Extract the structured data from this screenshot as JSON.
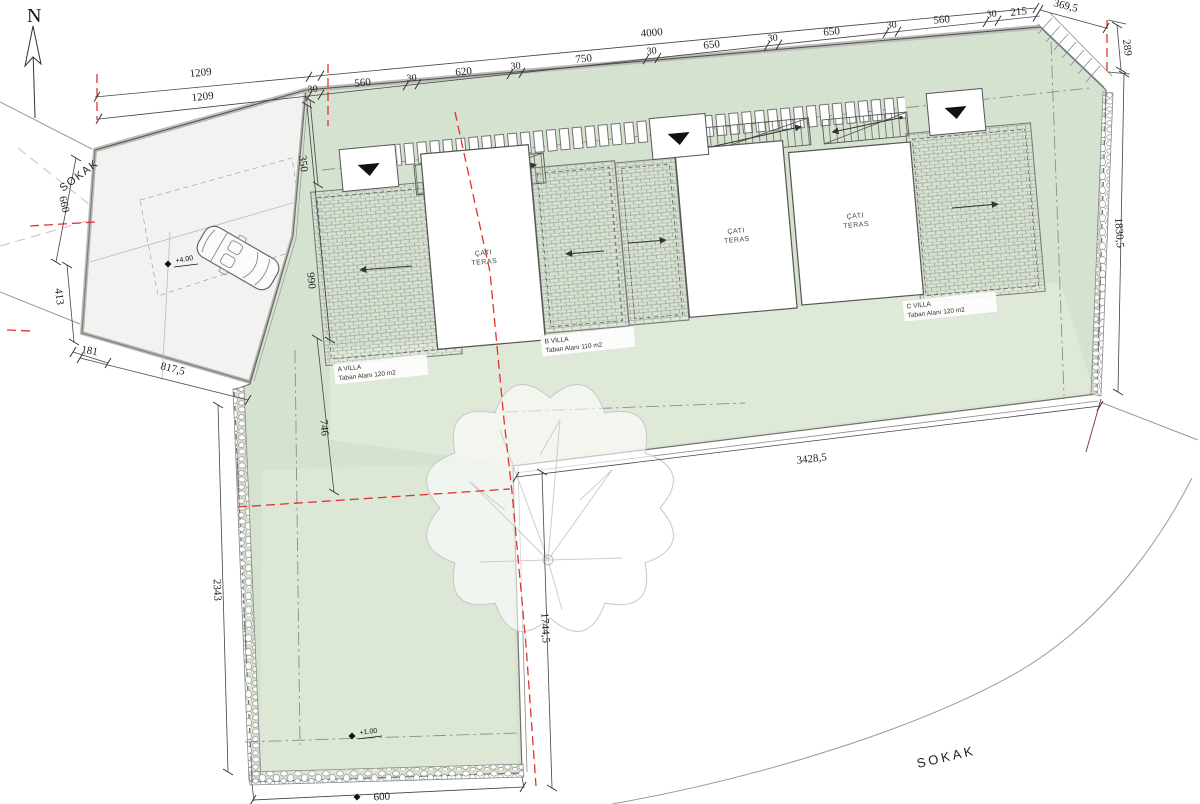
{
  "canvas": {
    "green": "#d6e2d0",
    "green_light": "#e4ecdc",
    "red": "#e03232",
    "wall_gray": "#9c9c98"
  },
  "compass": {
    "label": "N"
  },
  "streets": {
    "left": "SOKAK",
    "bottom": "SOKAK"
  },
  "dimensions": {
    "row1_left": "1209",
    "row2_left": "1209",
    "overall": "4000",
    "edge_top_right": "369,5",
    "segments": [
      "30",
      "560",
      "30",
      "620",
      "30",
      "750",
      "30",
      "650",
      "30",
      "650",
      "30",
      "560",
      "30",
      "215"
    ],
    "right_289": "289",
    "right_1830": "1830,5",
    "left_660": "660",
    "left_413": "413",
    "left_181": "181",
    "left_817": "817,5",
    "left_2343": "2343",
    "green_350": "350",
    "green_990": "990",
    "green_746": "746",
    "street_3428": "3428,5",
    "street_1744": "1744,5",
    "bottom_600": "600"
  },
  "roof_terrace": {
    "line1": "ÇATI",
    "line2": "TERAS"
  },
  "villas": [
    {
      "name": "A VİLLA",
      "area": "Taban Alanı 120 m2"
    },
    {
      "name": "B VİLLA",
      "area": "Taban Alanı 110 m2"
    },
    {
      "name": "C VİLLA",
      "area": "Taban Alanı 120 m2"
    }
  ],
  "elevations": {
    "parking": "+4.00",
    "garden": "+1.00"
  }
}
